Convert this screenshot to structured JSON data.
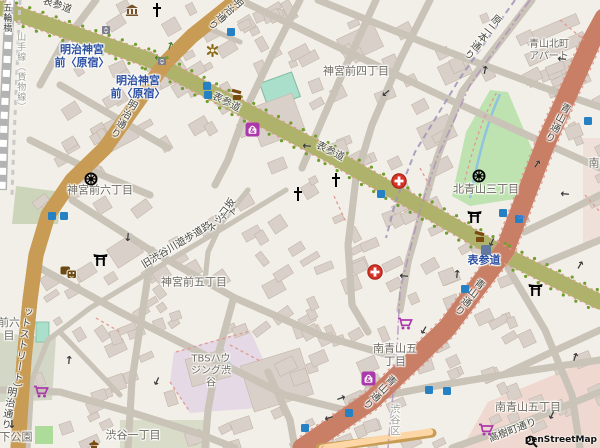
{
  "map": {
    "attribution": {
      "logo": "magnifier",
      "text": "penStreetMap"
    },
    "labels": [
      {
        "t": "神宮前四丁目",
        "x": 356,
        "y": 72,
        "c": "",
        "n": "place-label-jingumae-4chome"
      },
      {
        "t": "神宮前六丁目",
        "x": 100,
        "y": 191,
        "c": "",
        "n": "place-label-jingumae-6chome"
      },
      {
        "t": "神宮前五丁目",
        "x": 194,
        "y": 283,
        "c": "",
        "n": "place-label-jingumae-5chome"
      },
      {
        "t": "北青山三丁目",
        "x": 486,
        "y": 190,
        "c": "",
        "n": "place-label-kitaaoyama-3chome"
      },
      {
        "t": "南青山五\n丁目",
        "x": 395,
        "y": 356,
        "c": "",
        "n": "place-label-minamiaoyama-5chome-a"
      },
      {
        "t": "南青山五丁目",
        "x": 528,
        "y": 408,
        "c": "",
        "n": "place-label-minamiaoyama-5chome-b"
      },
      {
        "t": "渋谷一丁目",
        "x": 133,
        "y": 436,
        "c": "",
        "n": "place-label-shibuya-1chome"
      },
      {
        "t": "下公園",
        "x": 16,
        "y": 438,
        "c": "",
        "n": "place-label-miyashita-park-partial"
      },
      {
        "t": "青山北町\nアパート",
        "x": 549,
        "y": 51,
        "c": "md",
        "n": "place-label-aoyama-kitamachi-apartment"
      },
      {
        "t": "TBSハウ\nジング渋\n谷",
        "x": 211,
        "y": 371,
        "c": "md",
        "n": "place-label-tbs-housing-shibuya"
      },
      {
        "t": "前六\n目",
        "x": 9,
        "y": 330,
        "c": "",
        "n": "place-label-partial-left-edge"
      },
      {
        "t": "南",
        "x": 594,
        "y": 164,
        "c": "",
        "n": "place-label-partial-right-edge"
      },
      {
        "t": "渋谷区",
        "x": 393,
        "y": 420,
        "c": "md lt v",
        "n": "boundary-label-shibuya-ku"
      },
      {
        "t": "五輪橋",
        "x": 6,
        "y": 18,
        "c": "sm dk v",
        "n": "label-gorinbashi"
      },
      {
        "t": "山手線（貨物線）",
        "x": 20,
        "y": 72,
        "c": "sm lt v",
        "n": "label-yamanote-freight-line"
      },
      {
        "t": "明治神宮\n前〈原宿〉",
        "x": 82,
        "y": 57,
        "c": "st",
        "n": "station-label-meijijingumae-harajuku-1"
      },
      {
        "t": "明治神宮\n前〈原宿〉",
        "x": 138,
        "y": 88,
        "c": "st",
        "n": "station-label-meijijingumae-harajuku-2"
      },
      {
        "t": "表参道",
        "x": 484,
        "y": 261,
        "c": "st",
        "n": "station-label-omotesando"
      },
      {
        "t": "表参道",
        "x": 57,
        "y": 6,
        "c": "rd",
        "r": 19,
        "n": "road-label-omotesando-1"
      },
      {
        "t": "表参道",
        "x": 226,
        "y": 103,
        "c": "rd",
        "r": 27,
        "n": "road-label-omotesando-2"
      },
      {
        "t": "表参道",
        "x": 330,
        "y": 152,
        "c": "rd",
        "r": 27,
        "n": "road-label-omotesando-3"
      },
      {
        "t": "明治通り",
        "x": 122,
        "y": 118,
        "c": "rd v",
        "r": 30,
        "n": "road-label-meiji-dori-1"
      },
      {
        "t": "明治通り",
        "x": 224,
        "y": 12,
        "c": "rd v",
        "r": 48,
        "n": "road-label-meiji-dori-2"
      },
      {
        "t": "明治通り",
        "x": 7,
        "y": 408,
        "c": "rd v",
        "r": 10,
        "n": "road-label-meiji-dori-3"
      },
      {
        "t": "青山通り",
        "x": 468,
        "y": 296,
        "c": "rd v",
        "r": 37,
        "n": "road-label-aoyama-dori-1"
      },
      {
        "t": "青山通り",
        "x": 378,
        "y": 391,
        "c": "rd v",
        "r": 44,
        "n": "road-label-aoyama-dori-2"
      },
      {
        "t": "青山通り",
        "x": 556,
        "y": 122,
        "c": "rd v",
        "r": 28,
        "n": "road-label-aoyama-dori-3"
      },
      {
        "t": "原二本通り",
        "x": 481,
        "y": 36,
        "c": "rd v",
        "r": 38,
        "n": "road-label-haranihon-dori"
      },
      {
        "t": "旧渋谷川遊歩道路（キャ",
        "x": 190,
        "y": 238,
        "c": "rd",
        "r": -31,
        "n": "road-label-cat-street-a"
      },
      {
        "t": "ットストリート）",
        "x": 20,
        "y": 350,
        "c": "rd v",
        "r": 8,
        "n": "road-label-cat-street-b"
      },
      {
        "t": "ネッコ坂",
        "x": 222,
        "y": 216,
        "c": "rd",
        "r": -53,
        "n": "road-label-nekko-zaka"
      },
      {
        "t": "高樹町通り",
        "x": 513,
        "y": 431,
        "c": "rd",
        "r": -21,
        "n": "road-label-takagicho-dori"
      }
    ],
    "icons": [
      {
        "t": "hospital",
        "x": 391,
        "y": 173
      },
      {
        "t": "hospital",
        "x": 367,
        "y": 264
      },
      {
        "t": "church",
        "x": 151,
        "y": 3
      },
      {
        "t": "church",
        "x": 292,
        "y": 187
      },
      {
        "t": "church",
        "x": 330,
        "y": 173
      },
      {
        "t": "museum",
        "x": 125,
        "y": 4
      },
      {
        "t": "dharma-wheel",
        "x": 84,
        "y": 172
      },
      {
        "t": "dharma-wheel",
        "x": 472,
        "y": 169
      },
      {
        "t": "torii",
        "x": 93,
        "y": 253
      },
      {
        "t": "torii",
        "x": 467,
        "y": 210
      },
      {
        "t": "torii",
        "x": 528,
        "y": 283
      },
      {
        "t": "theatre-masks",
        "x": 60,
        "y": 266
      },
      {
        "t": "temple",
        "x": 87,
        "y": 439
      },
      {
        "t": "attraction-asterisk",
        "x": 206,
        "y": 44
      },
      {
        "t": "poi-brown",
        "x": 230,
        "y": 88
      },
      {
        "t": "poi-brown",
        "x": 473,
        "y": 230
      },
      {
        "t": "supermarket-cart",
        "x": 33,
        "y": 385
      },
      {
        "t": "supermarket-cart",
        "x": 397,
        "y": 317
      },
      {
        "t": "supermarket-cart",
        "x": 478,
        "y": 423
      },
      {
        "t": "department-store-bag",
        "x": 245,
        "y": 122
      },
      {
        "t": "department-store-bag",
        "x": 361,
        "y": 371
      },
      {
        "t": "subway-entrance",
        "x": 227,
        "y": 28
      },
      {
        "t": "subway-entrance",
        "x": 203,
        "y": 82
      },
      {
        "t": "subway-entrance",
        "x": 204,
        "y": 91
      },
      {
        "t": "subway-entrance",
        "x": 48,
        "y": 212
      },
      {
        "t": "subway-entrance",
        "x": 60,
        "y": 212
      },
      {
        "t": "subway-entrance",
        "x": 377,
        "y": 190
      },
      {
        "t": "subway-entrance",
        "x": 499,
        "y": 209
      },
      {
        "t": "subway-entrance",
        "x": 515,
        "y": 215
      },
      {
        "t": "subway-entrance",
        "x": 461,
        "y": 285
      },
      {
        "t": "subway-entrance",
        "x": 584,
        "y": 117
      },
      {
        "t": "subway-entrance",
        "x": 425,
        "y": 386
      },
      {
        "t": "subway-entrance",
        "x": 443,
        "y": 387
      },
      {
        "t": "subway-entrance",
        "x": 301,
        "y": 424
      },
      {
        "t": "subway-entrance",
        "x": 345,
        "y": 409
      },
      {
        "t": "elevator",
        "x": 102,
        "y": 26
      },
      {
        "t": "elevator",
        "x": 158,
        "y": 57
      },
      {
        "t": "station-square",
        "x": 481,
        "y": 245
      }
    ],
    "arrows": [
      {
        "x": 170,
        "y": 46,
        "r": -70,
        "c": "g"
      },
      {
        "x": 159,
        "y": 58,
        "r": 185,
        "c": "g"
      },
      {
        "x": 386,
        "y": 93,
        "r": 140
      },
      {
        "x": 485,
        "y": 70,
        "r": -80
      },
      {
        "x": 562,
        "y": 59,
        "r": 185
      },
      {
        "x": 537,
        "y": 164,
        "r": -55
      },
      {
        "x": 565,
        "y": 194,
        "r": 185
      },
      {
        "x": 492,
        "y": 242,
        "r": 115
      },
      {
        "x": 580,
        "y": 265,
        "r": -60
      },
      {
        "x": 404,
        "y": 276,
        "r": 185
      },
      {
        "x": 457,
        "y": 274,
        "r": -85
      },
      {
        "x": 424,
        "y": 330,
        "r": 120
      },
      {
        "x": 341,
        "y": 398,
        "r": -20
      },
      {
        "x": 329,
        "y": 418,
        "r": 163
      },
      {
        "x": 575,
        "y": 357,
        "r": -70
      },
      {
        "x": 552,
        "y": 415,
        "r": 115
      },
      {
        "x": 128,
        "y": 237,
        "r": 95
      },
      {
        "x": 69,
        "y": 360,
        "r": -85
      },
      {
        "x": 157,
        "y": 381,
        "r": 115
      },
      {
        "x": 12,
        "y": 424,
        "r": 90
      },
      {
        "x": 307,
        "y": 146,
        "r": 185
      },
      {
        "x": 522,
        "y": 216,
        "r": 185,
        "c": "b"
      },
      {
        "x": 585,
        "y": 437,
        "r": 185,
        "c": "b"
      }
    ],
    "colors": {
      "land": "#f2efe9",
      "building": "#d9d0c9",
      "trunk": "#f9b29c",
      "primary": "#fcd6a4",
      "secondary": "#f7fabf",
      "park": "#bee3b0",
      "pitch": "#aae0cb",
      "water": "#aad3df",
      "retail_area": "#e5d9e6",
      "commercial_area": "#efd8cf",
      "station_text": "#2b4fa2",
      "shop_icon": "#ac39ac",
      "tourism_icon": "#74512a",
      "hospital_icon": "#d63328",
      "subway_entrance": "#2581c4"
    }
  }
}
